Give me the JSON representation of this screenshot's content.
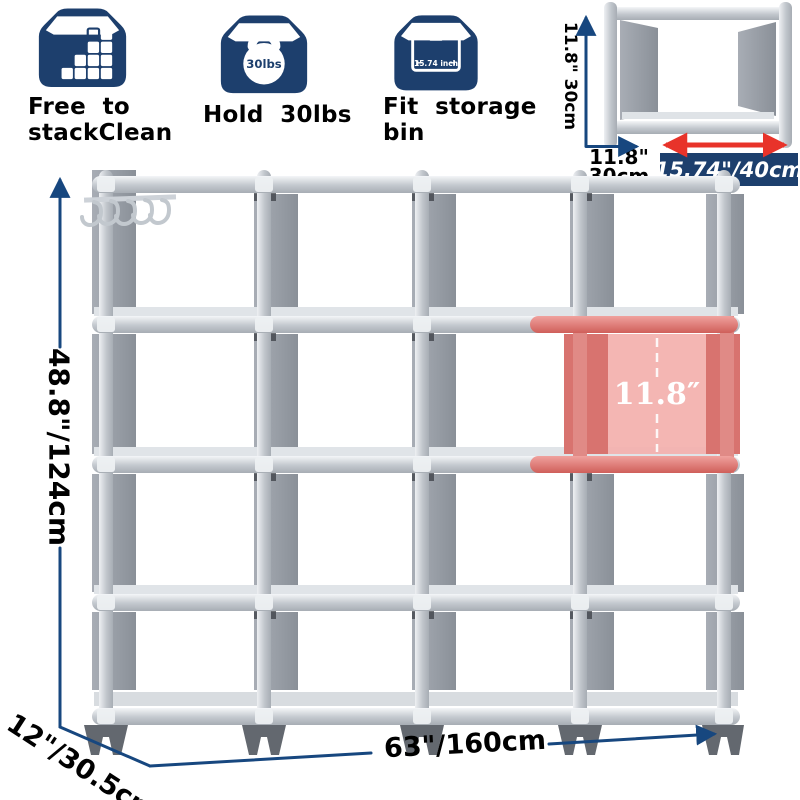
{
  "features": [
    {
      "icon": "stackable-cubes-icon",
      "line1": "Free  to",
      "line2": "stackClean"
    },
    {
      "icon": "kettlebell-icon",
      "line1": "Hold  30lbs",
      "line2": "",
      "weight_label": "30lbs"
    },
    {
      "icon": "storage-bin-icon",
      "line1": "Fit  storage",
      "line2": "bin",
      "bin_size_label": "15.74  inch"
    }
  ],
  "unit_diagram": {
    "side_height_label": "11.8\" 30cm",
    "depth_line1": "11.8\"",
    "depth_line2": "30cm",
    "width_badge": "15.74\"/40cm"
  },
  "shelf": {
    "cube_height_label": "11.8″"
  },
  "dimensions": {
    "height_label": "48.8\"/124cm",
    "depth_label": "12\"/30.5cm",
    "width_label": "63\"/160cm"
  },
  "colors": {
    "icon_navy": "#1d3f6d",
    "arrow_blue": "#17477f",
    "red_arrow": "#e8332a",
    "highlight_red": "#e08a86",
    "frame_silver": "#c3c8ce",
    "fabric_gray": "#979da5"
  }
}
